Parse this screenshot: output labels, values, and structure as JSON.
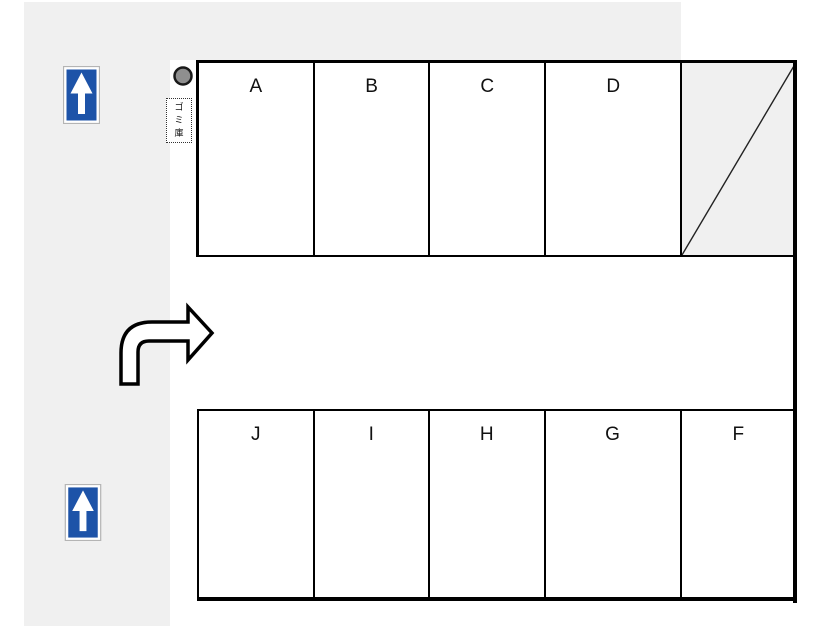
{
  "diagram": {
    "title": "parking-lot-map",
    "colors": {
      "background": "#ffffff",
      "road_gray": "#f0f0f0",
      "line_black": "#000000",
      "sign_blue": "#1d53a8",
      "sign_frame_gray": "#b4b4b4",
      "pole_gray": "#8f8f8f",
      "disabled_space_gray": "#f0f0f0"
    },
    "garbage_box": {
      "label": "ゴミ庫",
      "chars": [
        "ゴ",
        "ミ",
        "庫"
      ]
    },
    "parking_rows": {
      "top": {
        "spaces": [
          {
            "label": "A"
          },
          {
            "label": "B"
          },
          {
            "label": "C"
          },
          {
            "label": "D"
          },
          {
            "label": "",
            "crossed": true
          }
        ]
      },
      "bottom": {
        "spaces": [
          {
            "label": "J"
          },
          {
            "label": "I"
          },
          {
            "label": "H"
          },
          {
            "label": "G"
          },
          {
            "label": "F"
          }
        ]
      }
    },
    "icons": {
      "one_way_sign_top": "one-way-up-arrow-sign",
      "one_way_sign_bottom": "one-way-up-arrow-sign",
      "turn_arrow": "turn-right-curved-arrow",
      "pole": "pole-circle",
      "crossed_space": "diagonal-cross-line"
    }
  }
}
